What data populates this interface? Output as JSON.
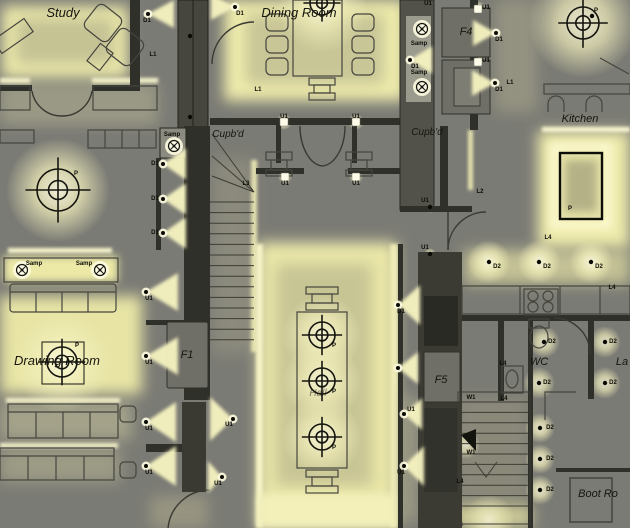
{
  "palette": {
    "background": "#7b7b75",
    "glow_bright": "#fdfbe0",
    "glow_mid": "#efecac",
    "glow_dim": "#c9c69e",
    "cone": "#f5f2bf",
    "wall": "#30302a",
    "panel": "#6f6f67",
    "ink": "#111108"
  },
  "room_labels": [
    {
      "text": "Study",
      "x": 63,
      "y": 17,
      "size": 13,
      "opacity": 1
    },
    {
      "text": "Dining Room",
      "x": 299,
      "y": 17,
      "size": 13,
      "opacity": 1
    },
    {
      "text": "Cupb'd",
      "x": 228,
      "y": 137,
      "size": 10,
      "opacity": 1
    },
    {
      "text": "Cupb'd",
      "x": 427,
      "y": 135,
      "size": 10,
      "opacity": 1
    },
    {
      "text": "Kitchen",
      "x": 580,
      "y": 122,
      "size": 11,
      "opacity": 1
    },
    {
      "text": "Drawing Room",
      "x": 57,
      "y": 365,
      "size": 13,
      "opacity": 1
    },
    {
      "text": "Hall",
      "x": 318,
      "y": 396,
      "size": 10,
      "opacity": 0.55
    },
    {
      "text": "WC",
      "x": 539,
      "y": 365,
      "size": 11,
      "opacity": 1
    },
    {
      "text": "La",
      "x": 622,
      "y": 365,
      "size": 11,
      "opacity": 1
    },
    {
      "text": "Boot Ro",
      "x": 598,
      "y": 497,
      "size": 11,
      "opacity": 1
    },
    {
      "text": "F4",
      "x": 466,
      "y": 35,
      "size": 11,
      "opacity": 1
    },
    {
      "text": "F1",
      "x": 187,
      "y": 358,
      "size": 11,
      "opacity": 1
    },
    {
      "text": "F5",
      "x": 441,
      "y": 383,
      "size": 11,
      "opacity": 1
    }
  ],
  "fixture_labels": [
    {
      "t": "D1",
      "x": 147,
      "y": 22
    },
    {
      "t": "L1",
      "x": 153,
      "y": 56
    },
    {
      "t": "D1",
      "x": 240,
      "y": 15
    },
    {
      "t": "L1",
      "x": 258,
      "y": 91
    },
    {
      "t": "U1",
      "x": 284,
      "y": 118
    },
    {
      "t": "U1",
      "x": 356,
      "y": 118
    },
    {
      "t": "U1",
      "x": 428,
      "y": 5
    },
    {
      "t": "Samp",
      "x": 419,
      "y": 45
    },
    {
      "t": "D1",
      "x": 415,
      "y": 68
    },
    {
      "t": "Samp",
      "x": 419,
      "y": 74
    },
    {
      "t": "U1",
      "x": 486,
      "y": 9
    },
    {
      "t": "D1",
      "x": 499,
      "y": 41
    },
    {
      "t": "U1",
      "x": 486,
      "y": 62
    },
    {
      "t": "D1",
      "x": 499,
      "y": 91
    },
    {
      "t": "L1",
      "x": 510,
      "y": 84
    },
    {
      "t": "P",
      "x": 596,
      "y": 12
    },
    {
      "t": "Samp",
      "x": 172,
      "y": 136
    },
    {
      "t": "D1",
      "x": 155,
      "y": 165
    },
    {
      "t": "D1",
      "x": 155,
      "y": 200
    },
    {
      "t": "D1",
      "x": 155,
      "y": 234
    },
    {
      "t": "L3",
      "x": 246,
      "y": 185
    },
    {
      "t": "U1",
      "x": 285,
      "y": 185
    },
    {
      "t": "U1",
      "x": 356,
      "y": 185
    },
    {
      "t": "L2",
      "x": 480,
      "y": 193
    },
    {
      "t": "U1",
      "x": 425,
      "y": 202
    },
    {
      "t": "U1",
      "x": 425,
      "y": 249
    },
    {
      "t": "P",
      "x": 570,
      "y": 210
    },
    {
      "t": "L4",
      "x": 548,
      "y": 239
    },
    {
      "t": "D2",
      "x": 497,
      "y": 268
    },
    {
      "t": "D2",
      "x": 547,
      "y": 268
    },
    {
      "t": "D2",
      "x": 599,
      "y": 268
    },
    {
      "t": "L4",
      "x": 612,
      "y": 289
    },
    {
      "t": "D2",
      "x": 552,
      "y": 343
    },
    {
      "t": "D2",
      "x": 613,
      "y": 343
    },
    {
      "t": "L4",
      "x": 503,
      "y": 365
    },
    {
      "t": "D2",
      "x": 547,
      "y": 384
    },
    {
      "t": "D2",
      "x": 613,
      "y": 384
    },
    {
      "t": "U1",
      "x": 149,
      "y": 300
    },
    {
      "t": "U1",
      "x": 149,
      "y": 364
    },
    {
      "t": "U1",
      "x": 149,
      "y": 430
    },
    {
      "t": "U1",
      "x": 149,
      "y": 474
    },
    {
      "t": "U1",
      "x": 229,
      "y": 426
    },
    {
      "t": "U1",
      "x": 218,
      "y": 485
    },
    {
      "t": "D1",
      "x": 401,
      "y": 313
    },
    {
      "t": "U1",
      "x": 411,
      "y": 411
    },
    {
      "t": "U1",
      "x": 401,
      "y": 474
    },
    {
      "t": "W1",
      "x": 471,
      "y": 399
    },
    {
      "t": "L4",
      "x": 504,
      "y": 400
    },
    {
      "t": "W1",
      "x": 471,
      "y": 454
    },
    {
      "t": "L4",
      "x": 460,
      "y": 483
    },
    {
      "t": "D2",
      "x": 550,
      "y": 429
    },
    {
      "t": "D2",
      "x": 550,
      "y": 460
    },
    {
      "t": "D2",
      "x": 550,
      "y": 491
    },
    {
      "t": "P",
      "x": 334,
      "y": 347
    },
    {
      "t": "P",
      "x": 334,
      "y": 393
    },
    {
      "t": "P",
      "x": 334,
      "y": 449
    },
    {
      "t": "P",
      "x": 76,
      "y": 175
    },
    {
      "t": "P",
      "x": 77,
      "y": 347
    },
    {
      "t": "Samp",
      "x": 34,
      "y": 265
    },
    {
      "t": "Samp",
      "x": 84,
      "y": 265
    }
  ],
  "fixtures": {
    "pendants": [
      {
        "x": 322,
        "y": 3,
        "r": 12
      },
      {
        "x": 583,
        "y": 23,
        "r": 16
      },
      {
        "x": 58,
        "y": 190,
        "r": 21
      },
      {
        "x": 62,
        "y": 362,
        "r": 15,
        "plate": [
          42,
          342,
          42,
          42
        ]
      },
      {
        "x": 322,
        "y": 335,
        "r": 13
      },
      {
        "x": 322,
        "y": 381,
        "r": 13
      },
      {
        "x": 322,
        "y": 437,
        "r": 13
      }
    ],
    "samp": [
      {
        "x": 422,
        "y": 29
      },
      {
        "x": 422,
        "y": 87
      },
      {
        "x": 174,
        "y": 146
      },
      {
        "x": 22,
        "y": 270
      },
      {
        "x": 100,
        "y": 270
      }
    ],
    "cones": [
      {
        "x": 148,
        "y": 14,
        "d": "right",
        "l": 26,
        "h": 14
      },
      {
        "x": 235,
        "y": 7,
        "d": "left",
        "l": 24,
        "h": 13
      },
      {
        "x": 410,
        "y": 60,
        "d": "right",
        "l": 22,
        "h": 14
      },
      {
        "x": 496,
        "y": 33,
        "d": "left",
        "l": 23,
        "h": 13
      },
      {
        "x": 495,
        "y": 83,
        "d": "left",
        "l": 23,
        "h": 13
      },
      {
        "x": 163,
        "y": 164,
        "d": "right",
        "l": 23,
        "h": 16
      },
      {
        "x": 163,
        "y": 199,
        "d": "right",
        "l": 23,
        "h": 16
      },
      {
        "x": 163,
        "y": 233,
        "d": "right",
        "l": 23,
        "h": 16
      },
      {
        "x": 146,
        "y": 292,
        "d": "right",
        "l": 32,
        "h": 19
      },
      {
        "x": 146,
        "y": 356,
        "d": "right",
        "l": 32,
        "h": 19
      },
      {
        "x": 146,
        "y": 422,
        "d": "right",
        "l": 30,
        "h": 20
      },
      {
        "x": 146,
        "y": 466,
        "d": "right",
        "l": 30,
        "h": 20
      },
      {
        "x": 233,
        "y": 419,
        "d": "left",
        "l": 23,
        "h": 22
      },
      {
        "x": 222,
        "y": 477,
        "d": "left",
        "l": 14,
        "h": 16
      },
      {
        "x": 398,
        "y": 305,
        "d": "right",
        "l": 22,
        "h": 20
      },
      {
        "x": 398,
        "y": 368,
        "d": "right",
        "l": 20,
        "h": 16
      },
      {
        "x": 404,
        "y": 414,
        "d": "right",
        "l": 18,
        "h": 16
      },
      {
        "x": 404,
        "y": 466,
        "d": "right",
        "l": 20,
        "h": 20
      }
    ],
    "uplight_squares": [
      {
        "x": 284,
        "y": 122
      },
      {
        "x": 356,
        "y": 122
      },
      {
        "x": 285,
        "y": 177
      },
      {
        "x": 356,
        "y": 177
      },
      {
        "x": 478,
        "y": 9
      },
      {
        "x": 478,
        "y": 62
      }
    ],
    "dots": [
      {
        "x": 489,
        "y": 262
      },
      {
        "x": 539,
        "y": 262
      },
      {
        "x": 591,
        "y": 262
      },
      {
        "x": 544,
        "y": 342
      },
      {
        "x": 605,
        "y": 342
      },
      {
        "x": 539,
        "y": 383
      },
      {
        "x": 605,
        "y": 383
      },
      {
        "x": 540,
        "y": 428
      },
      {
        "x": 540,
        "y": 459
      },
      {
        "x": 540,
        "y": 490
      },
      {
        "x": 430,
        "y": 207
      },
      {
        "x": 430,
        "y": 254
      },
      {
        "x": 190,
        "y": 36
      },
      {
        "x": 190,
        "y": 117
      },
      {
        "x": 592,
        "y": 16
      }
    ],
    "pools": [
      {
        "x": 583,
        "y": 23,
        "r": 55,
        "o": 0.85
      },
      {
        "x": 58,
        "y": 190,
        "r": 52,
        "o": 0.9
      },
      {
        "x": 62,
        "y": 362,
        "r": 50,
        "o": 0.9
      },
      {
        "x": 322,
        "y": 8,
        "r": 45,
        "o": 0.8
      },
      {
        "x": 322,
        "y": 335,
        "r": 40,
        "o": 0.85
      },
      {
        "x": 322,
        "y": 381,
        "r": 40,
        "o": 0.85
      },
      {
        "x": 322,
        "y": 437,
        "r": 40,
        "o": 0.85
      },
      {
        "x": 489,
        "y": 262,
        "r": 22,
        "o": 0.9
      },
      {
        "x": 539,
        "y": 262,
        "r": 22,
        "o": 0.9
      },
      {
        "x": 591,
        "y": 262,
        "r": 22,
        "o": 0.9
      },
      {
        "x": 544,
        "y": 342,
        "r": 16,
        "o": 0.8
      },
      {
        "x": 605,
        "y": 342,
        "r": 16,
        "o": 0.8
      },
      {
        "x": 539,
        "y": 383,
        "r": 16,
        "o": 0.8
      },
      {
        "x": 605,
        "y": 383,
        "r": 16,
        "o": 0.8
      },
      {
        "x": 540,
        "y": 428,
        "r": 15,
        "o": 0.85
      },
      {
        "x": 540,
        "y": 459,
        "r": 15,
        "o": 0.85
      },
      {
        "x": 540,
        "y": 490,
        "r": 15,
        "o": 0.85
      },
      {
        "x": 466,
        "y": 445,
        "r": 14,
        "o": 0.75
      },
      {
        "x": 489,
        "y": 520,
        "r": 26,
        "o": 0.7
      },
      {
        "x": 440,
        "y": 520,
        "r": 20,
        "o": 0.6
      },
      {
        "x": 428,
        "y": 320,
        "r": 10,
        "o": 0.7
      },
      {
        "x": 432,
        "y": 412,
        "r": 8,
        "o": 0.6
      },
      {
        "x": 444,
        "y": 450,
        "r": 8,
        "o": 0.6
      },
      {
        "x": 422,
        "y": 29,
        "r": 10,
        "o": 0.9
      },
      {
        "x": 422,
        "y": 87,
        "r": 10,
        "o": 0.9
      },
      {
        "x": 174,
        "y": 146,
        "r": 10,
        "o": 0.9
      },
      {
        "x": 22,
        "y": 270,
        "r": 9,
        "o": 0.9
      },
      {
        "x": 100,
        "y": 270,
        "r": 9,
        "o": 0.9
      },
      {
        "x": 284,
        "y": 122,
        "r": 8,
        "o": 0.95
      },
      {
        "x": 356,
        "y": 122,
        "r": 8,
        "o": 0.95
      },
      {
        "x": 285,
        "y": 177,
        "r": 7,
        "o": 0.9
      },
      {
        "x": 356,
        "y": 177,
        "r": 7,
        "o": 0.9
      },
      {
        "x": 478,
        "y": 9,
        "r": 8,
        "o": 0.95
      },
      {
        "x": 478,
        "y": 62,
        "r": 8,
        "o": 0.95
      },
      {
        "x": 430,
        "y": 207,
        "r": 6,
        "o": 0.8
      },
      {
        "x": 430,
        "y": 254,
        "r": 6,
        "o": 0.8
      },
      {
        "x": 190,
        "y": 36,
        "r": 6,
        "o": 0.8
      },
      {
        "x": 190,
        "y": 117,
        "r": 6,
        "o": 0.8
      }
    ]
  }
}
